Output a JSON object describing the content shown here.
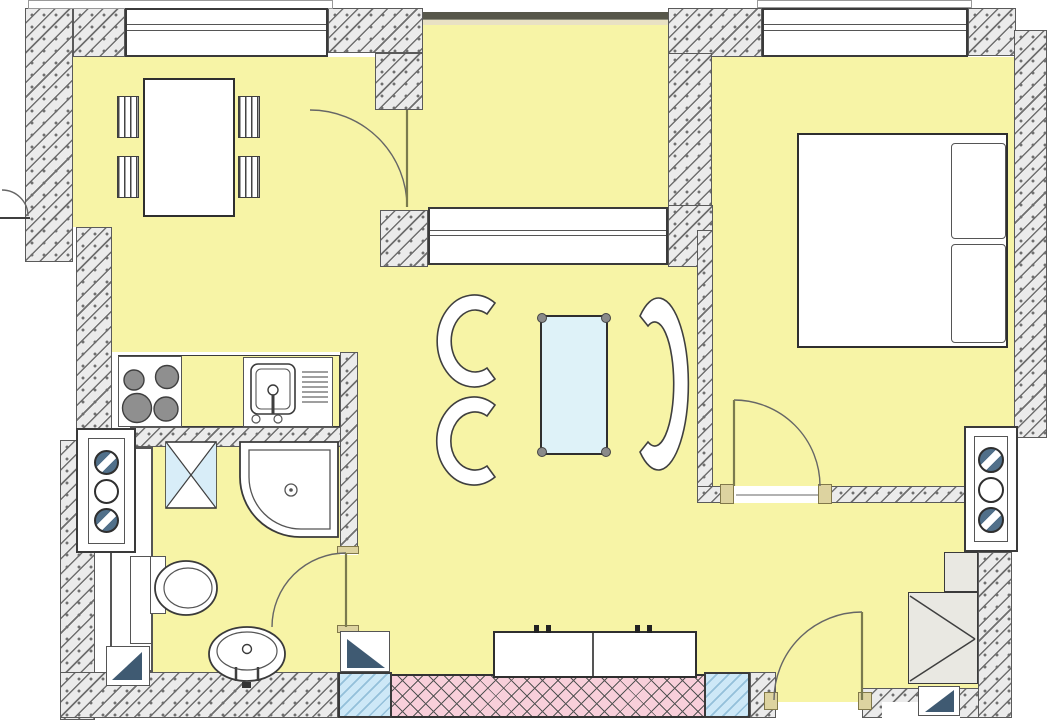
{
  "document": {
    "type": "architectural-floor-plan",
    "description": "one-bedroom apartment floor plan, no text labels",
    "visible_text": []
  },
  "colors": {
    "floor": "#f7f4a6",
    "wallFill": "#ebebeb",
    "wallLine": "#6f6f6f",
    "outline": "#3a3a3a",
    "glassFill": "#cde8f7",
    "glassLine": "#94c0da",
    "pinkFill": "#f8cfda",
    "pinkLine": "#555555",
    "tableGlass": "#def2f8",
    "navy": "#3f5a72",
    "tanFill": "#ddd3a0",
    "tanLine": "#81784a",
    "grayFill": "#e9e8e2",
    "burner": "#8f8f8f",
    "shaftDark": "#51708a",
    "bandDark": "#56564a",
    "bandTan": "#e9e1c4",
    "white": "#ffffff",
    "furnLine": "#3f3f3f"
  },
  "rooms": [
    {
      "name": "dining-area"
    },
    {
      "name": "kitchen"
    },
    {
      "name": "living-room"
    },
    {
      "name": "loggia"
    },
    {
      "name": "bedroom"
    },
    {
      "name": "bathroom"
    },
    {
      "name": "entry-hall"
    }
  ],
  "furniture": [
    "dining-table",
    "dining-chair x4",
    "kitchen-stove",
    "kitchen-sink-unit",
    "armchair x2",
    "sofa",
    "coffee-table",
    "sideboard",
    "double-bed",
    "pillow x2",
    "shower",
    "toilet",
    "washbasin",
    "washing-machine",
    "service-shaft x2",
    "wardrobe-gray-unit"
  ],
  "doors": [
    "dining-to-loggia-door",
    "bathroom-door",
    "bedroom-door",
    "entrance-door"
  ],
  "windows": [
    "dining-window",
    "bedroom-window",
    "loggia-glazing",
    "loggia-living-window",
    "glass-panel-left",
    "glass-panel-right"
  ]
}
